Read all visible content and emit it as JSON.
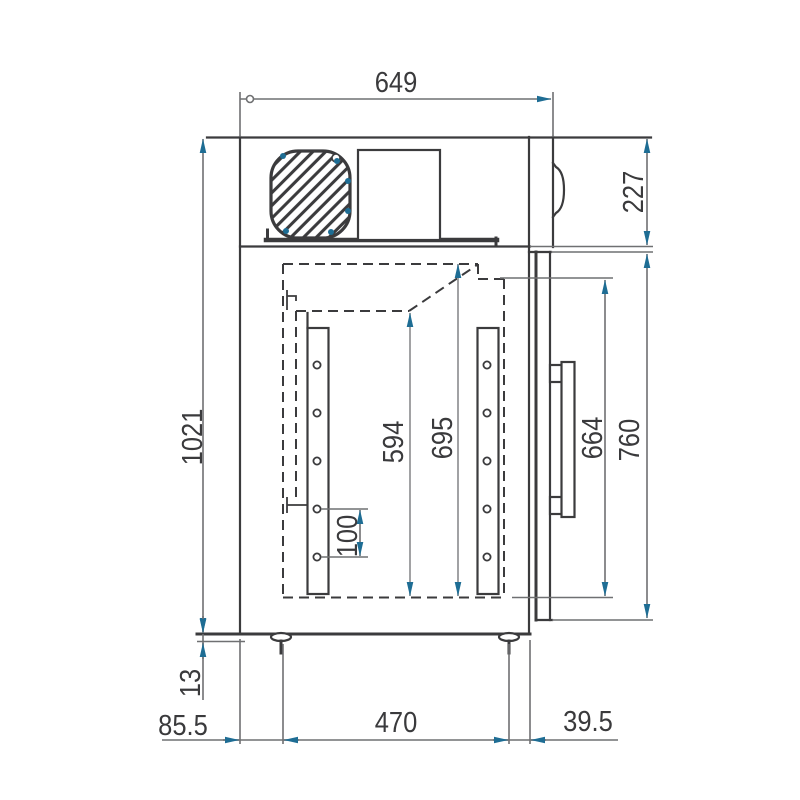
{
  "colors": {
    "object_line": "#3b3b3d",
    "dim_line": "#6f7072",
    "dim_light": "#97989a",
    "arrow": "#1e6d94",
    "label": "#3a3a3c",
    "background": "#ffffff"
  },
  "labels": {
    "depth_top": "649",
    "condensing_unit_height": "227",
    "overall_height": "1021",
    "interior_back_height": "594",
    "interior_height": "695",
    "door_inner_height": "664",
    "door_height": "760",
    "shelf_hole_pitch": "100",
    "foot_height": "13",
    "foot_offset_back": "85.5",
    "foot_spacing": "470",
    "foot_offset_front": "39.5"
  }
}
